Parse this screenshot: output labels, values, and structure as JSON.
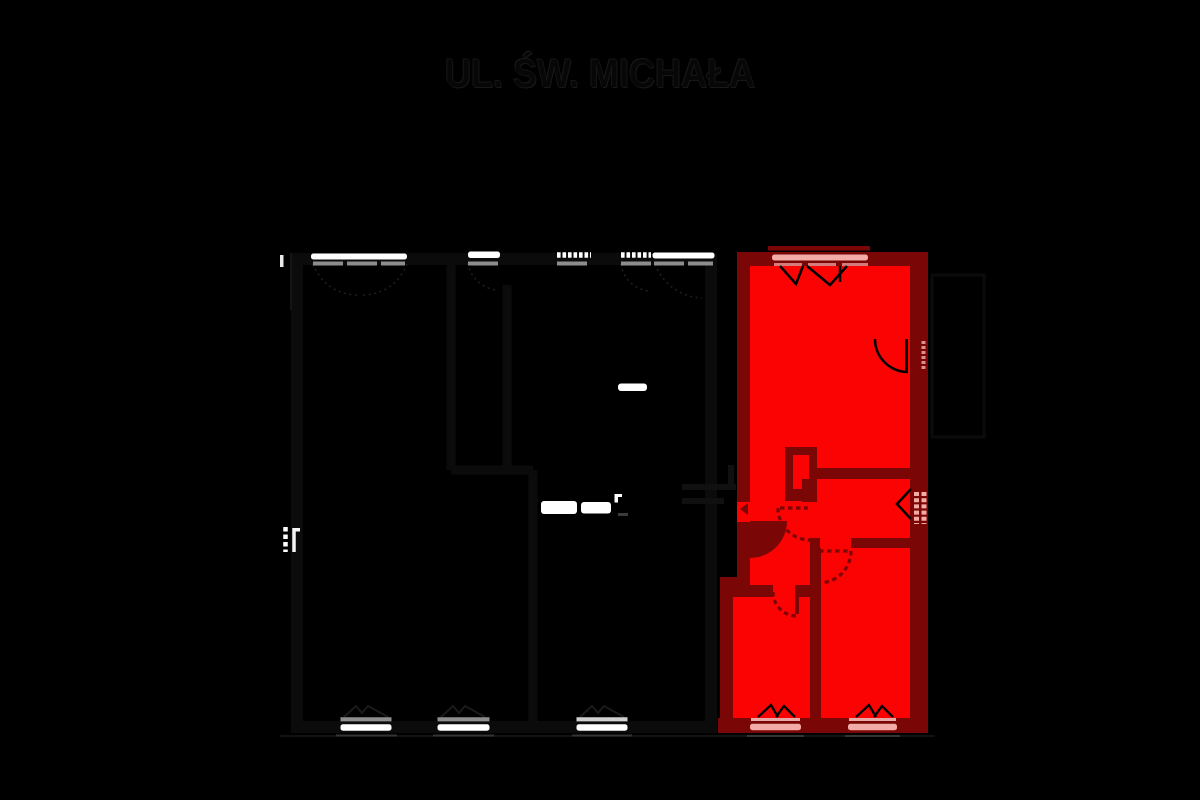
{
  "title": "UL. ŚW. MICHAŁA",
  "diagram": {
    "kind": "building floor plan with one highlighted apartment",
    "highlighted_unit_selected": true,
    "features": [
      "street-name-label",
      "top-facade-windows",
      "highlighted-apartment-unit",
      "closet-box",
      "door-swing-arcs",
      "entrance-door",
      "balcony-door",
      "side-wall-window",
      "bottom-facade-windows",
      "stair-landing-marks"
    ]
  },
  "colors": {
    "bg": "#000000",
    "unit-fill": "#fb0303",
    "unit-wall": "#7a0606",
    "unit-window": "#f2aba6",
    "window-white": "#ffffff",
    "window-dim": "#8d8d8d",
    "title-ink": "#070707"
  }
}
